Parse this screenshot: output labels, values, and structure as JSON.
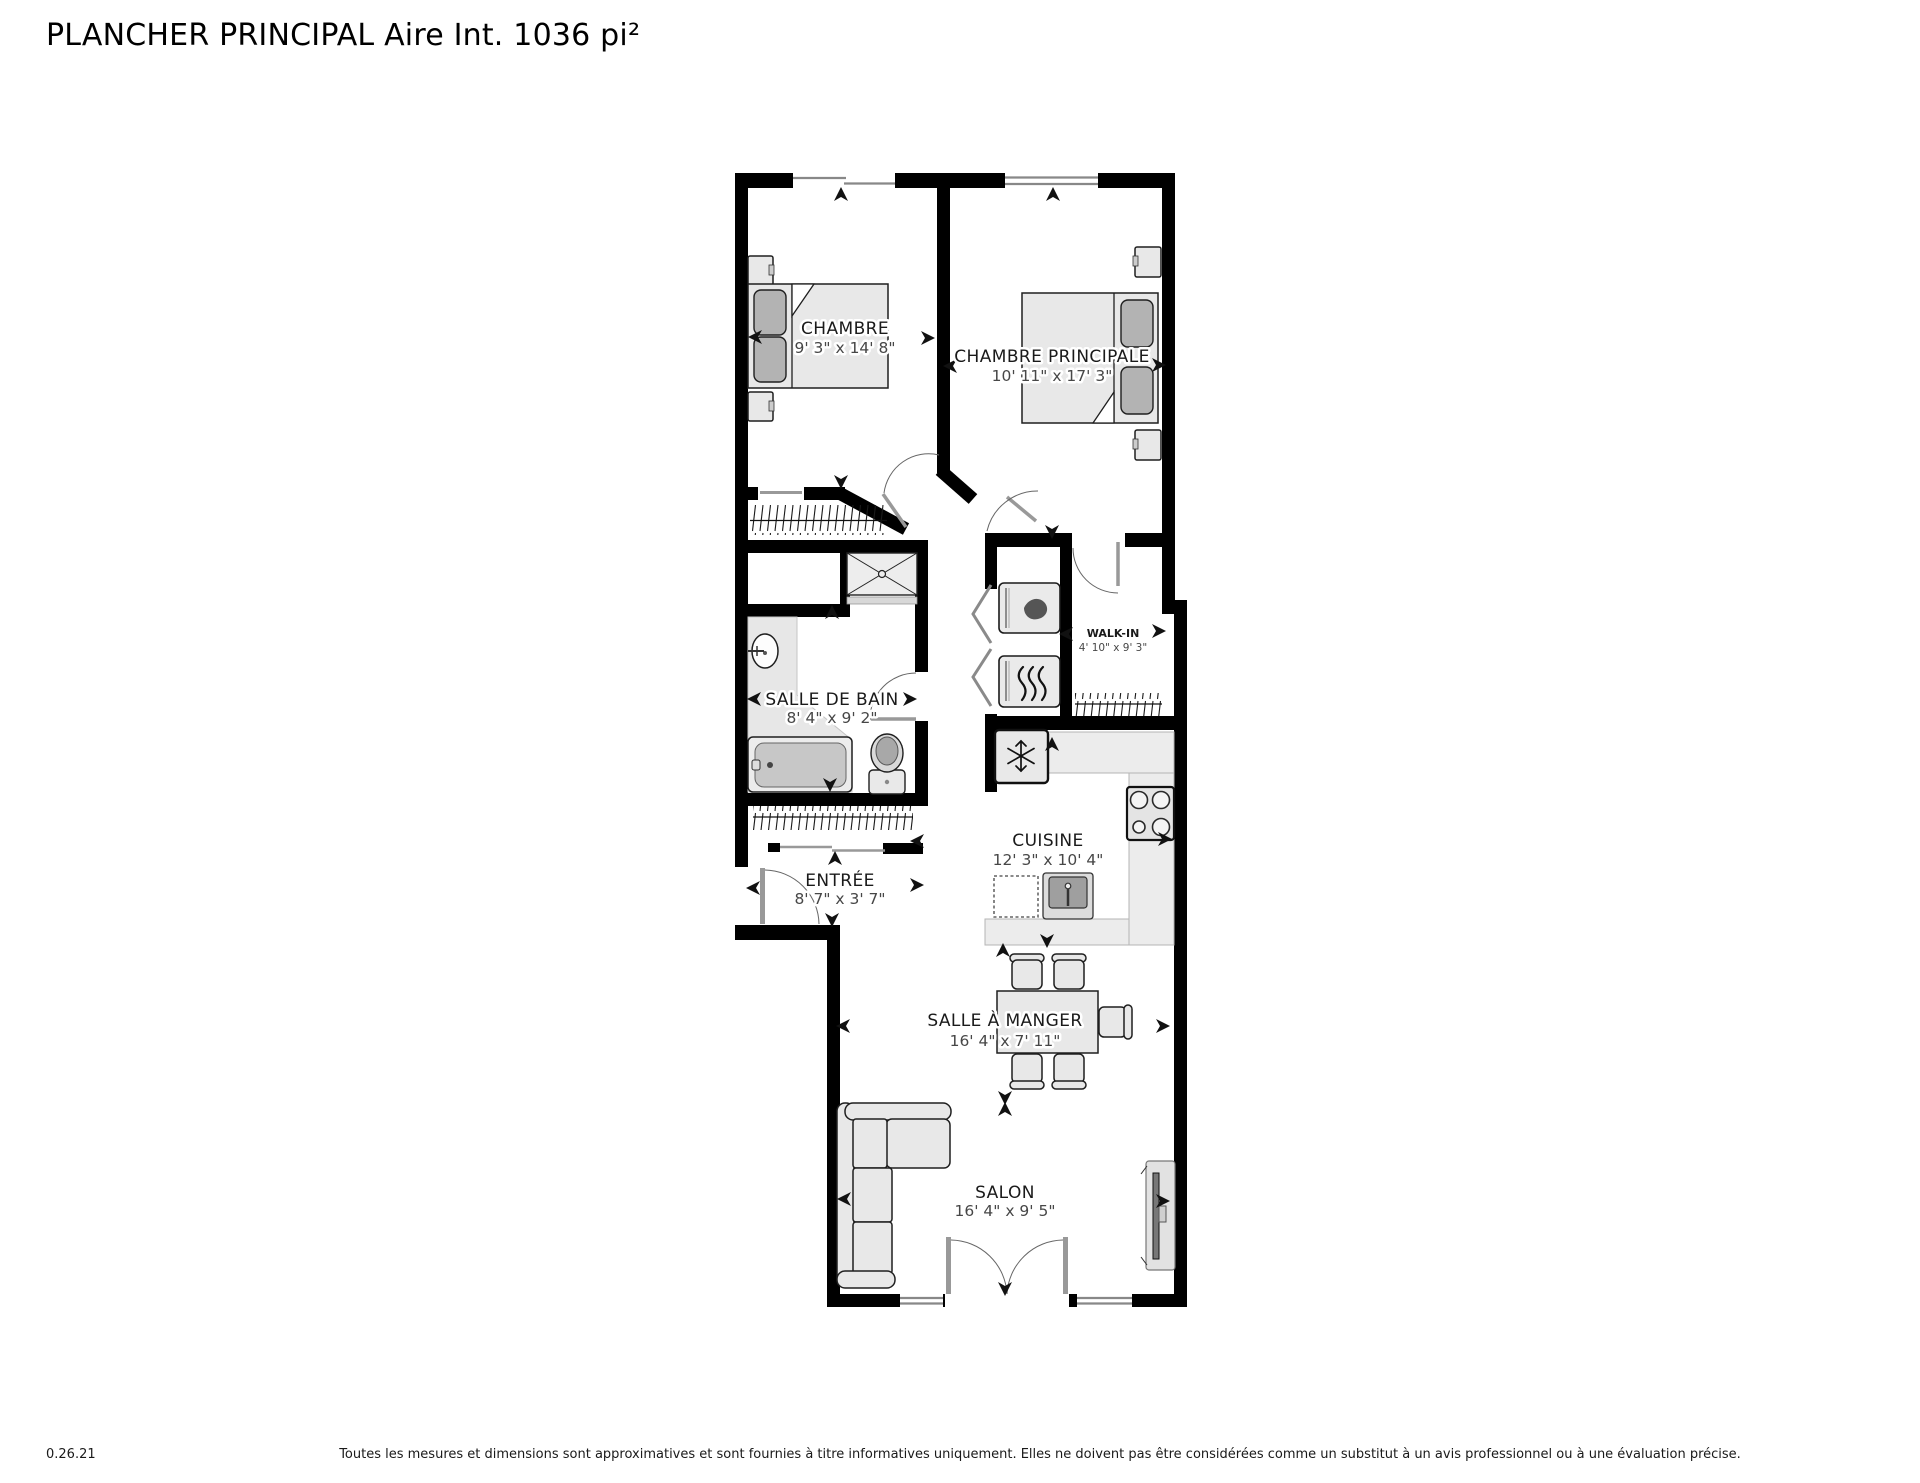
{
  "title": "PLANCHER PRINCIPAL Aire Int. 1036 pi²",
  "rooms": {
    "chambre": {
      "name": "CHAMBRE",
      "dims": "9' 3\" x 14' 8\""
    },
    "chambre_principale": {
      "name": "CHAMBRE PRINCIPALE",
      "dims": "10' 11\" x 17' 3\""
    },
    "salle_de_bain": {
      "name": "SALLE DE BAIN",
      "dims": "8' 4\" x 9' 2\""
    },
    "walk_in": {
      "name": "WALK-IN",
      "dims": "4' 10\" x 9' 3\""
    },
    "cuisine": {
      "name": "CUISINE",
      "dims": "12' 3\" x 10' 4\""
    },
    "entree": {
      "name": "ENTRÉE",
      "dims": "8' 7\" x 3' 7\""
    },
    "salle_a_manger": {
      "name": "SALLE À MANGER",
      "dims": "16' 4\" x 7' 11\""
    },
    "salon": {
      "name": "SALON",
      "dims": "16' 4\" x 9' 5\""
    }
  },
  "footer": {
    "version": "0.26.21",
    "disclaimer": "Toutes les mesures et dimensions sont approximatives et sont fournies à titre informatives uniquement. Elles ne doivent pas être considérées comme un substitut à un avis professionnel ou à une évaluation précise."
  },
  "icons": {
    "washer": "water-drop-icon",
    "dryer": "heat-waves-icon",
    "fridge": "snowflake-icon",
    "stove": "burners-icon"
  },
  "colors": {
    "wall": "#000000",
    "furniture_fill": "#e8e8e8",
    "furniture_stroke": "#1f1f1f",
    "pillow": "#b3b3b3",
    "counter": "#ececec",
    "door": "#999999",
    "label": "#1a1a1a",
    "dims": "#474747",
    "background": "#ffffff"
  }
}
